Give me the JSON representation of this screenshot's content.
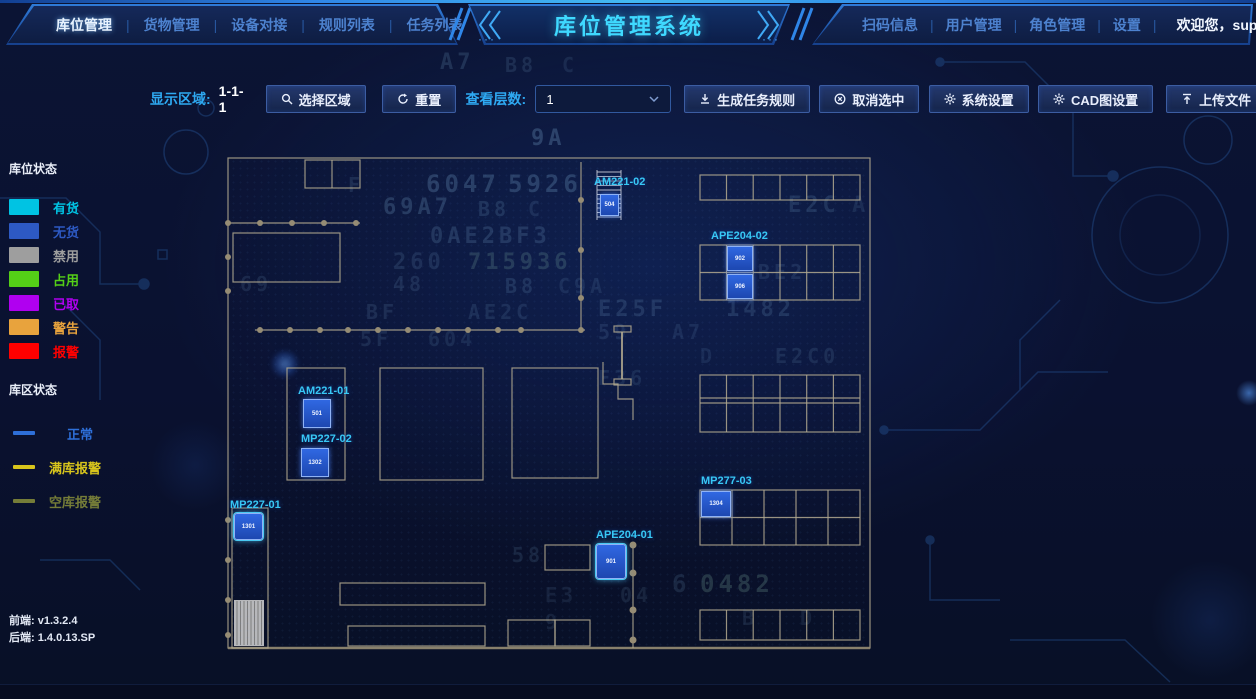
{
  "header": {
    "title": "库位管理系统",
    "nav_left": [
      {
        "label": "库位管理"
      },
      {
        "label": "货物管理"
      },
      {
        "label": "设备对接"
      },
      {
        "label": "规则列表"
      },
      {
        "label": "任务列表"
      }
    ],
    "nav_right": [
      {
        "label": "扫码信息"
      },
      {
        "label": "用户管理"
      },
      {
        "label": "角色管理"
      },
      {
        "label": "设置"
      }
    ],
    "welcome": "欢迎您，super"
  },
  "toolbar": {
    "display_area_label": "显示区域:",
    "display_area_value": "1-1-1",
    "select_area_btn": "选择区域",
    "reset_btn": "重置",
    "layer_label": "查看层数:",
    "layer_value": "1",
    "gen_task_btn": "生成任务规则",
    "cancel_select_btn": "取消选中",
    "sys_settings_btn": "系统设置",
    "cad_settings_btn": "CAD图设置",
    "upload_btn": "上传文件"
  },
  "legend": {
    "location_title": "库位状态",
    "location_items": [
      {
        "label": "有货",
        "color": "#00c3e3"
      },
      {
        "label": "无货",
        "color": "#2d59c3"
      },
      {
        "label": "禁用",
        "color": "#9e9e9e"
      },
      {
        "label": "占用",
        "color": "#54cf17"
      },
      {
        "label": "已取",
        "color": "#b000f0"
      },
      {
        "label": "警告",
        "color": "#e8a33d"
      },
      {
        "label": "报警",
        "color": "#ff0000"
      }
    ],
    "zone_title": "库区状态",
    "zone_items": [
      {
        "label": "正常",
        "color": "#2e6fd8"
      },
      {
        "label": "满库报警",
        "color": "#d8c51c"
      },
      {
        "label": "空库报警",
        "color": "#99a13c"
      }
    ]
  },
  "map": {
    "zones": [
      {
        "label": "AM221-02",
        "cell": "504"
      },
      {
        "label": "APE204-02",
        "cell_top": "902",
        "cell_bottom": "906"
      },
      {
        "label": "AM221-01",
        "cell": "501"
      },
      {
        "label": "MP227-02",
        "cell": "1302"
      },
      {
        "label": "MP227-01",
        "cell": "1301"
      },
      {
        "label": "APE204-01",
        "cell": "901"
      },
      {
        "label": "MP277-03",
        "cell": "1304"
      }
    ]
  },
  "footer": {
    "frontend": "前端: v1.3.2.4",
    "backend": "1.4.0.13.SP",
    "backend_label": "后端:"
  },
  "background": {
    "hex": [
      {
        "t": "A7",
        "x": 440,
        "y": 50,
        "s": 22,
        "o": 0.16
      },
      {
        "t": "B8",
        "x": 505,
        "y": 53,
        "s": 20,
        "o": 0.13
      },
      {
        "t": "C",
        "x": 562,
        "y": 53,
        "s": 20,
        "o": 0.11
      },
      {
        "t": "9A",
        "x": 531,
        "y": 126,
        "s": 22,
        "o": 0.24
      },
      {
        "t": "F",
        "x": 348,
        "y": 173,
        "s": 20,
        "o": 0.13
      },
      {
        "t": "6047",
        "x": 426,
        "y": 170,
        "s": 24,
        "o": 0.22
      },
      {
        "t": "5926",
        "x": 508,
        "y": 170,
        "s": 24,
        "o": 0.22
      },
      {
        "t": "69A7",
        "x": 383,
        "y": 195,
        "s": 22,
        "o": 0.2
      },
      {
        "t": "B8",
        "x": 478,
        "y": 197,
        "s": 20,
        "o": 0.15
      },
      {
        "t": "C",
        "x": 528,
        "y": 197,
        "s": 20,
        "o": 0.12
      },
      {
        "t": "0AE2BF3",
        "x": 430,
        "y": 224,
        "s": 22,
        "o": 0.17
      },
      {
        "t": "260",
        "x": 393,
        "y": 250,
        "s": 22,
        "o": 0.13
      },
      {
        "t": "715936",
        "x": 468,
        "y": 250,
        "s": 22,
        "o": 0.17,
        "c": "#9fd9c0"
      },
      {
        "t": "69",
        "x": 240,
        "y": 272,
        "s": 20,
        "o": 0.12
      },
      {
        "t": "48",
        "x": 393,
        "y": 272,
        "s": 20,
        "o": 0.13
      },
      {
        "t": "B8",
        "x": 505,
        "y": 274,
        "s": 20,
        "o": 0.14
      },
      {
        "t": "C9A",
        "x": 558,
        "y": 274,
        "s": 20,
        "o": 0.11
      },
      {
        "t": "BF",
        "x": 366,
        "y": 300,
        "s": 20,
        "o": 0.13
      },
      {
        "t": "AE2C",
        "x": 468,
        "y": 300,
        "s": 20,
        "o": 0.12
      },
      {
        "t": "5F",
        "x": 360,
        "y": 327,
        "s": 20,
        "o": 0.12
      },
      {
        "t": "604",
        "x": 428,
        "y": 327,
        "s": 20,
        "o": 0.11
      },
      {
        "t": "E25F",
        "x": 598,
        "y": 297,
        "s": 22,
        "o": 0.15
      },
      {
        "t": "1482",
        "x": 726,
        "y": 297,
        "s": 22,
        "o": 0.15
      },
      {
        "t": "59",
        "x": 598,
        "y": 320,
        "s": 20,
        "o": 0.12
      },
      {
        "t": "A7",
        "x": 672,
        "y": 320,
        "s": 20,
        "o": 0.11
      },
      {
        "t": "F36",
        "x": 598,
        "y": 366,
        "s": 20,
        "o": 0.11
      },
      {
        "t": "D",
        "x": 700,
        "y": 344,
        "s": 20,
        "o": 0.1
      },
      {
        "t": "E2C0",
        "x": 775,
        "y": 344,
        "s": 20,
        "o": 0.12
      },
      {
        "t": "E2C",
        "x": 788,
        "y": 193,
        "s": 22,
        "o": 0.15
      },
      {
        "t": "A",
        "x": 852,
        "y": 193,
        "s": 22,
        "o": 0.11
      },
      {
        "t": "BE2",
        "x": 758,
        "y": 260,
        "s": 20,
        "o": 0.12
      },
      {
        "t": "58",
        "x": 512,
        "y": 543,
        "s": 20,
        "o": 0.12
      },
      {
        "t": "C0",
        "x": 600,
        "y": 553,
        "s": 20,
        "o": 0.13
      },
      {
        "t": "E3",
        "x": 545,
        "y": 583,
        "s": 20,
        "o": 0.1
      },
      {
        "t": "04",
        "x": 620,
        "y": 583,
        "s": 20,
        "o": 0.11
      },
      {
        "t": "6",
        "x": 672,
        "y": 570,
        "s": 24,
        "o": 0.13
      },
      {
        "t": "0482",
        "x": 700,
        "y": 570,
        "s": 24,
        "o": 0.19,
        "c": "#9fd9c0"
      },
      {
        "t": "9",
        "x": 545,
        "y": 610,
        "s": 20,
        "o": 0.1
      },
      {
        "t": "B",
        "x": 742,
        "y": 606,
        "s": 20,
        "o": 0.11
      },
      {
        "t": "D",
        "x": 800,
        "y": 606,
        "s": 20,
        "o": 0.1
      }
    ]
  }
}
